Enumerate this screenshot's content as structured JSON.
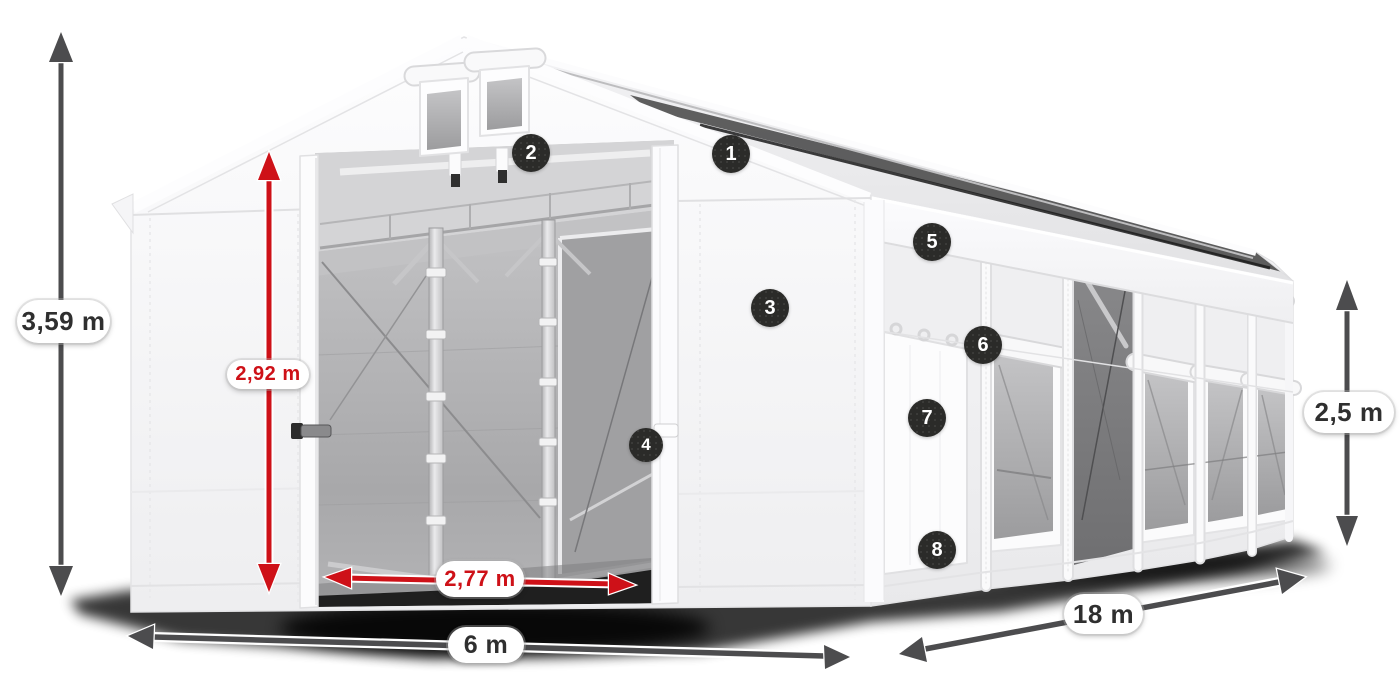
{
  "title": "Storage tent with dimension annotations",
  "colors": {
    "background": "#ffffff",
    "dimension_red": "#ce1118",
    "dimension_gray": "#4c4c4e",
    "badge_bg": "#2b2b29",
    "badge_text": "#ffffff",
    "pill_bg": "#ffffff",
    "pill_text": "#2f2f2f"
  },
  "dimensions": {
    "total_height": {
      "label": "3,59 m",
      "style": "gray"
    },
    "entrance_height": {
      "label": "2,92 m",
      "style": "red"
    },
    "entrance_width": {
      "label": "2,77 m",
      "style": "red"
    },
    "width": {
      "label": "6 m",
      "style": "gray"
    },
    "length": {
      "label": "18 m",
      "style": "gray"
    },
    "side_height": {
      "label": "2,5 m",
      "style": "gray"
    }
  },
  "badges": [
    {
      "number": "1"
    },
    {
      "number": "2"
    },
    {
      "number": "3"
    },
    {
      "number": "4"
    },
    {
      "number": "5"
    },
    {
      "number": "6"
    },
    {
      "number": "7"
    },
    {
      "number": "8"
    }
  ]
}
